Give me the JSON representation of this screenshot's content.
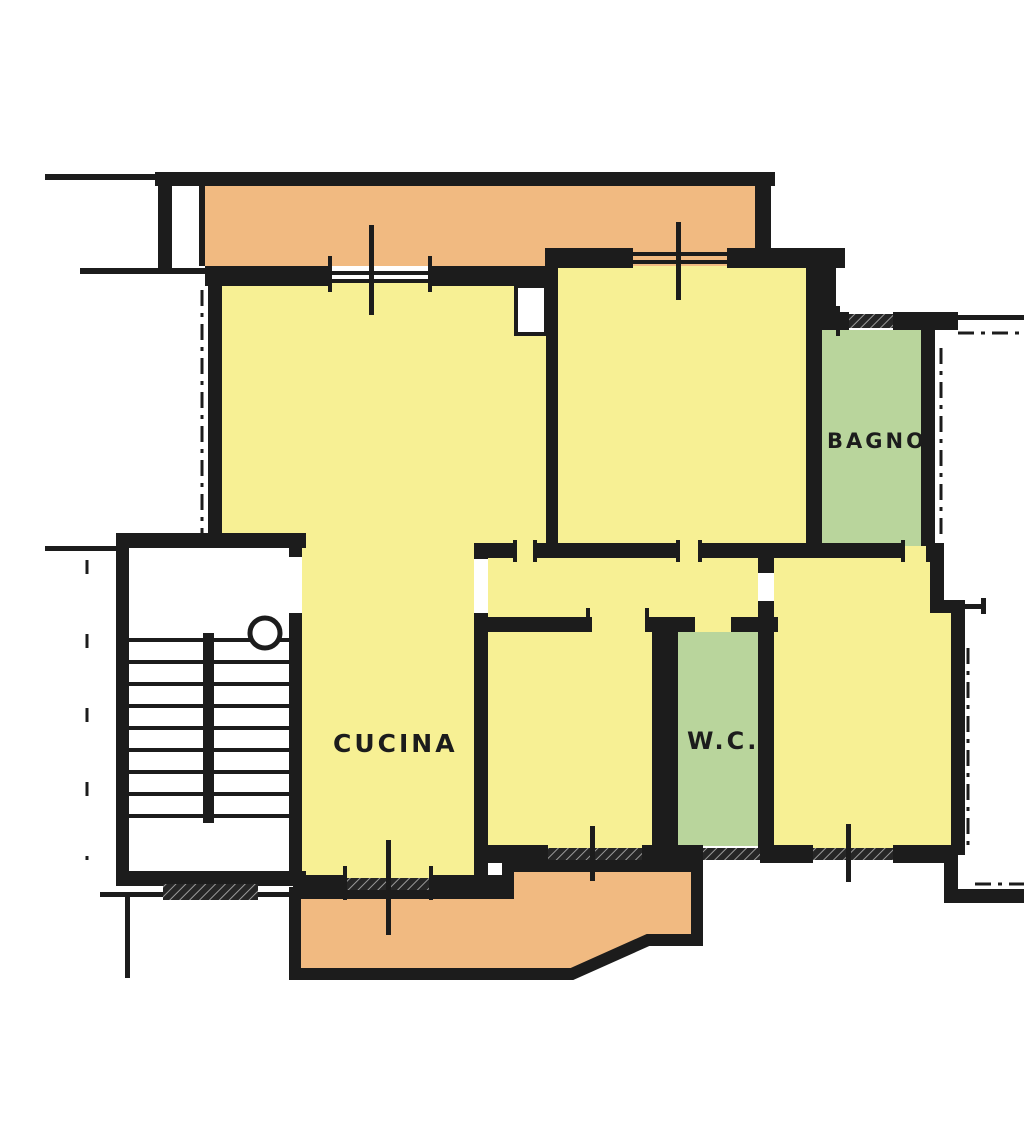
{
  "plan": {
    "labels": {
      "kitchen": "CUCINA",
      "bathroom": "BAGNO",
      "wc": "W.C."
    },
    "colors": {
      "room": "#f7f094",
      "service": "#b9d59c",
      "balcony": "#f1ba81",
      "wall": "#1c1c1c",
      "background": "#ffffff"
    }
  }
}
